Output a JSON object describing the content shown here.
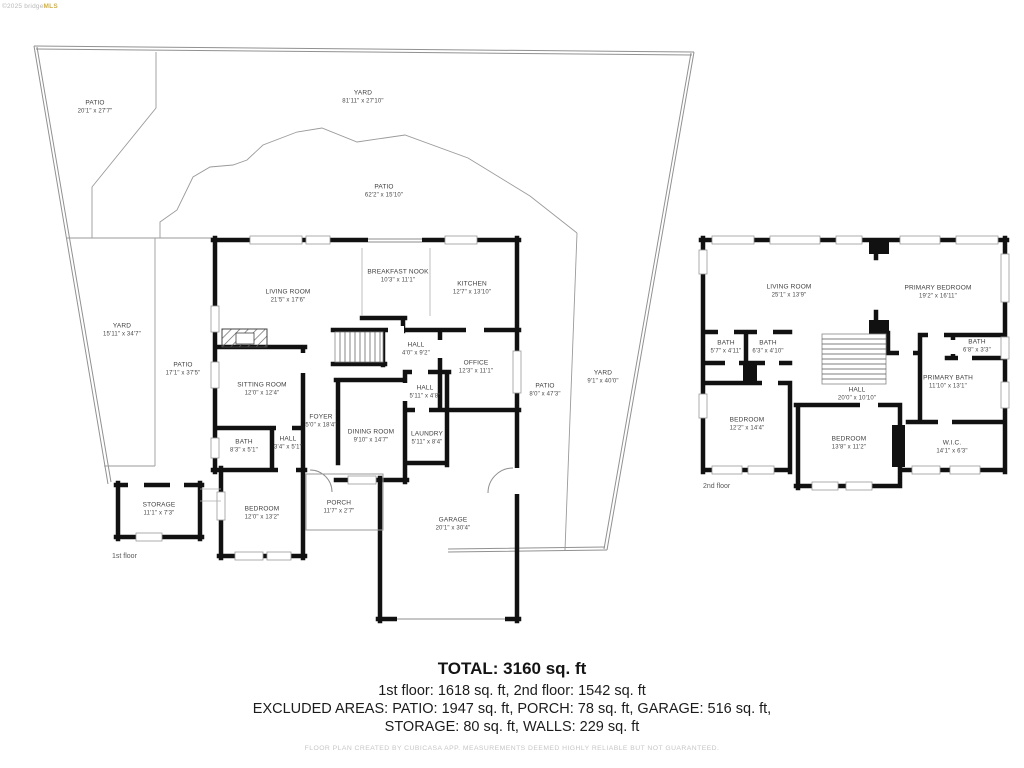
{
  "watermark": {
    "prefix": "©2025 bridge",
    "suffix": "MLS"
  },
  "floor1": {
    "caption": "1st floor",
    "outdoor": [
      {
        "name": "PATIO",
        "dims": "20'1\" x 27'7\""
      },
      {
        "name": "YARD",
        "dims": "81'11\" x 27'10\""
      },
      {
        "name": "PATIO",
        "dims": "62'2\" x 15'10\""
      },
      {
        "name": "YARD",
        "dims": "15'11\" x 34'7\""
      },
      {
        "name": "PATIO",
        "dims": "17'1\" x 37'5\""
      },
      {
        "name": "PATIO",
        "dims": "8'0\" x 47'3\""
      },
      {
        "name": "YARD",
        "dims": "9'1\" x 40'0\""
      }
    ],
    "rooms": [
      {
        "name": "LIVING ROOM",
        "dims": "21'5\" x 17'6\""
      },
      {
        "name": "BREAKFAST NOOK",
        "dims": "10'3\" x 11'1\""
      },
      {
        "name": "KITCHEN",
        "dims": "12'7\" x 13'10\""
      },
      {
        "name": "HALL",
        "dims": "4'0\" x 9'2\""
      },
      {
        "name": "OFFICE",
        "dims": "12'3\" x 11'1\""
      },
      {
        "name": "SITTING ROOM",
        "dims": "12'0\" x 12'4\""
      },
      {
        "name": "FOYER",
        "dims": "5'0\" x 18'4\""
      },
      {
        "name": "DINING ROOM",
        "dims": "9'10\" x 14'7\""
      },
      {
        "name": "HALL",
        "dims": "5'11\" x 4'8\""
      },
      {
        "name": "LAUNDRY",
        "dims": "5'11\" x 8'4\""
      },
      {
        "name": "BATH",
        "dims": "8'3\" x 5'1\""
      },
      {
        "name": "HALL",
        "dims": "3'4\" x 5'1\""
      },
      {
        "name": "BEDROOM",
        "dims": "12'0\" x 13'2\""
      },
      {
        "name": "PORCH",
        "dims": "11'7\" x 2'7\""
      },
      {
        "name": "GARAGE",
        "dims": "20'1\" x 30'4\""
      },
      {
        "name": "STORAGE",
        "dims": "11'1\" x 7'3\""
      }
    ]
  },
  "floor2": {
    "caption": "2nd floor",
    "rooms": [
      {
        "name": "LIVING ROOM",
        "dims": "25'1\" x 13'9\""
      },
      {
        "name": "PRIMARY BEDROOM",
        "dims": "19'2\" x 16'11\""
      },
      {
        "name": "BATH",
        "dims": "5'7\" x 4'11\""
      },
      {
        "name": "BATH",
        "dims": "6'3\" x 4'10\""
      },
      {
        "name": "BATH",
        "dims": "6'8\" x 3'3\""
      },
      {
        "name": "HALL",
        "dims": "20'0\" x 10'10\""
      },
      {
        "name": "PRIMARY BATH",
        "dims": "11'10\" x 13'1\""
      },
      {
        "name": "BEDROOM",
        "dims": "12'2\" x 14'4\""
      },
      {
        "name": "BEDROOM",
        "dims": "13'8\" x 11'2\""
      },
      {
        "name": "W.I.C.",
        "dims": "14'1\" x 6'3\""
      }
    ]
  },
  "summary": {
    "total": "TOTAL: 3160 sq. ft",
    "floors": "1st floor: 1618 sq. ft, 2nd floor: 1542 sq. ft",
    "excluded_line1": "EXCLUDED AREAS: PATIO: 1947 sq. ft, PORCH: 78 sq. ft, GARAGE: 516 sq. ft,",
    "excluded_line2": "STORAGE: 80 sq. ft, WALLS: 229 sq. ft",
    "disclaimer": "FLOOR PLAN CREATED BY CUBICASA APP. MEASUREMENTS DEEMED HIGHLY RELIABLE BUT NOT GUARANTEED."
  },
  "colors": {
    "wall": "#111111",
    "boundary": "#919191",
    "label": "#3f3f3f",
    "gold": "#d4af37"
  }
}
